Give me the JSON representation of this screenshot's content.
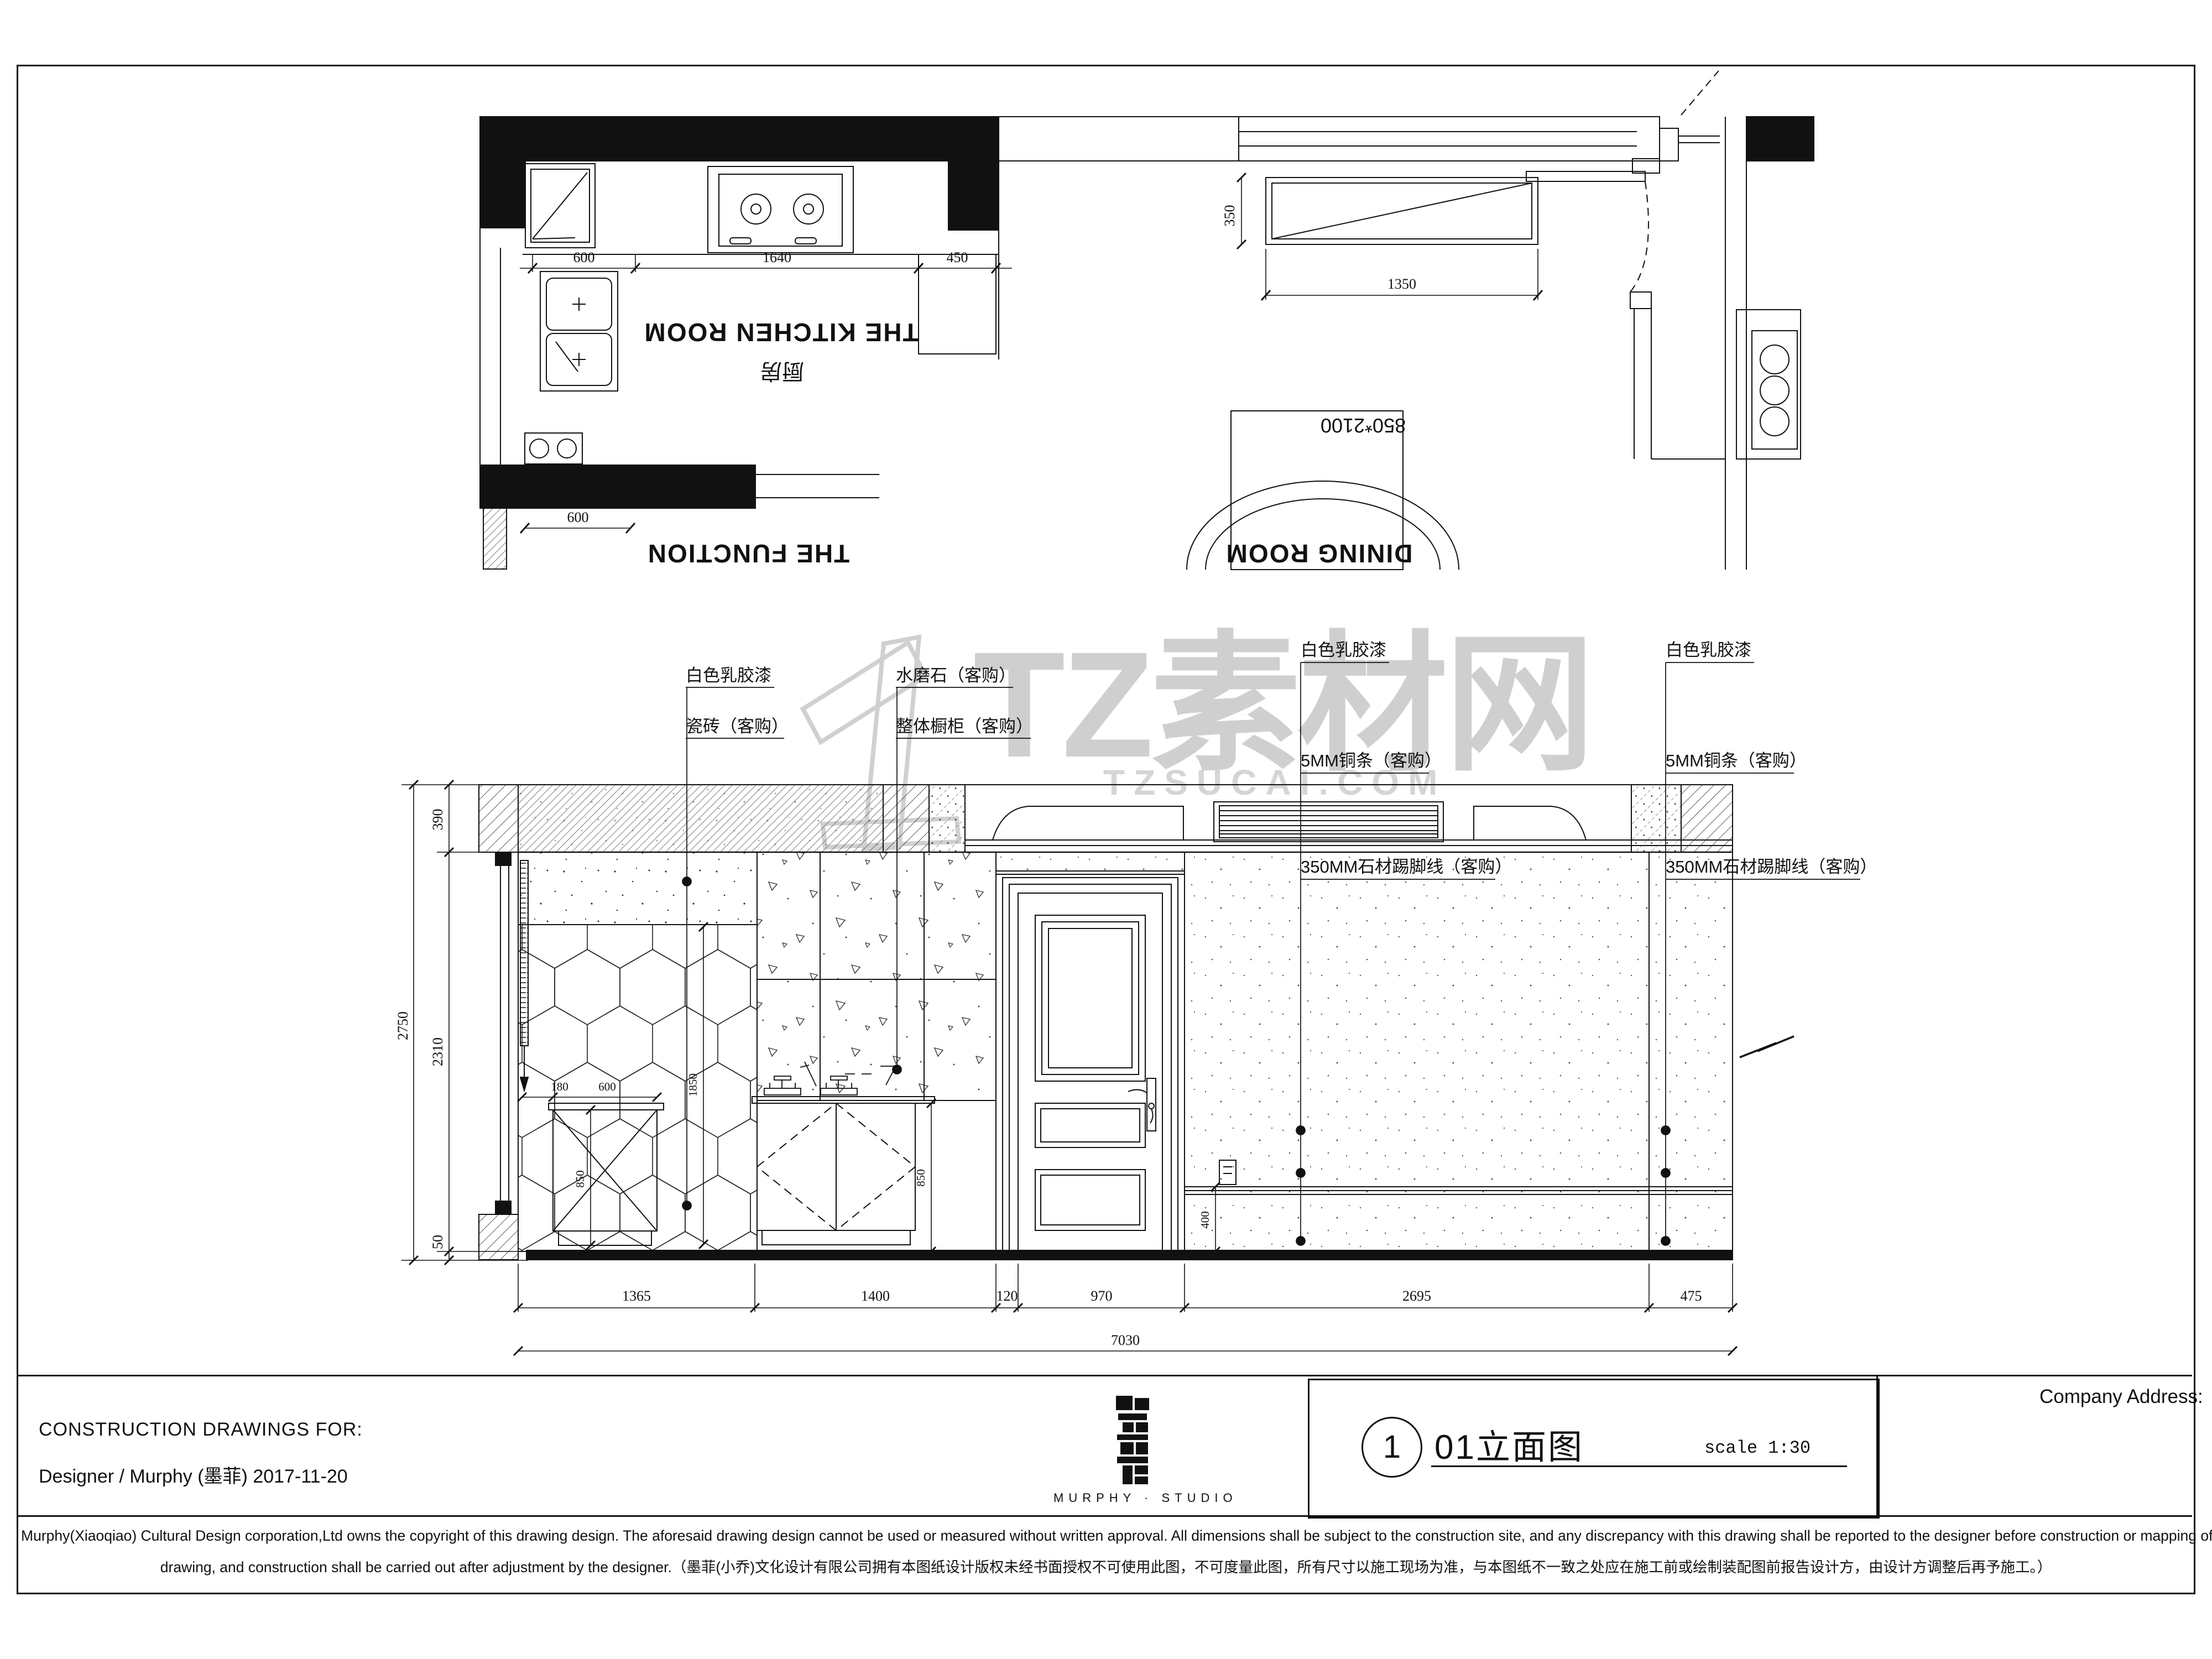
{
  "watermark": {
    "logo_numeral": "1",
    "brand_text": "TZ素材网",
    "site_text": "TZSUCAI.COM",
    "color": "#ababab"
  },
  "floor_plan": {
    "room_labels": {
      "kitchen_en": "THE KITCHEN ROOM",
      "kitchen_cn": "厨房",
      "function_en": "THE FUNCTION",
      "dining_en": "DINING ROOM"
    },
    "door_size_label": "850*2100",
    "dims": {
      "top_segments": [
        "600",
        "1640",
        "450"
      ],
      "bottom": "600",
      "window_height": "350",
      "window_width": "1350"
    }
  },
  "elevation": {
    "finish_labels": {
      "left": [
        "白色乳胶漆",
        "瓷砖（客购）"
      ],
      "middle": [
        "水磨石（客购）",
        "整体橱柜（客购）"
      ],
      "right_inner": [
        "白色乳胶漆",
        "5MM铜条（客购）",
        "350MM石材踢脚线（客购）"
      ],
      "right_outer": [
        "白色乳胶漆",
        "5MM铜条（客购）",
        "350MM石材踢脚线（客购）"
      ]
    },
    "dims": {
      "overall_height": "2750",
      "ceiling_band": "390",
      "wall_height": "2310",
      "base": "50",
      "bottom_segments": [
        "1365",
        "1400",
        "120",
        "970",
        "2695",
        "475"
      ],
      "total_width": "7030",
      "cabinet_offset": "180",
      "cabinet_width": "600",
      "cabinet_height_left": "850",
      "tile_height": "1850",
      "cabinet_height_right": "850",
      "skirting_height": "400"
    }
  },
  "title_block": {
    "construction_for": "CONSTRUCTION DRAWINGS FOR:",
    "designer_line": "Designer / Murphy (墨菲) 2017-11-20",
    "studio_caption": "MURPHY · STUDIO",
    "sheet_number": "1",
    "drawing_title": "01立面图",
    "scale_label": "scale 1:30",
    "company_address": "Company Address:"
  },
  "disclaimer": {
    "line1": "Murphy(Xiaoqiao) Cultural Design corporation,Ltd owns the copyright of this drawing design. The aforesaid drawing design cannot be used or measured without written approval. All dimensions shall be subject to the construction site, and any discrepancy with this drawing shall be reported to the designer before construction or mapping of assembly",
    "line2": "drawing, and construction shall be carried out after adjustment by the designer.（墨菲(小乔)文化设计有限公司拥有本图纸设计版权未经书面授权不可使用此图，不可度量此图，所有尺寸以施工现场为准，与本图纸不一致之处应在施工前或绘制装配图前报告设计方，由设计方调整后再予施工。）"
  }
}
